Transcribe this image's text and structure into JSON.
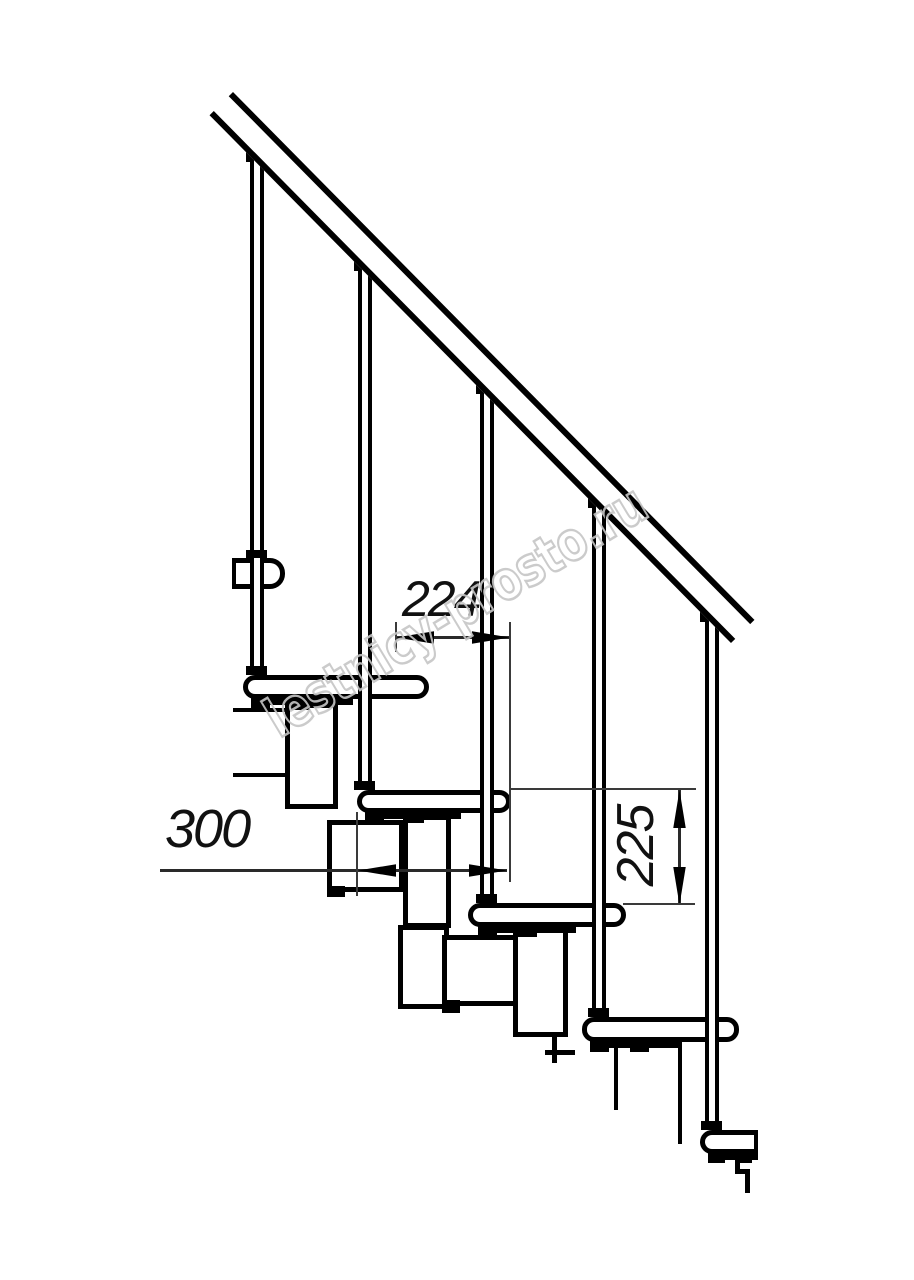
{
  "drawing": {
    "title": "Modular staircase side-view technical drawing",
    "watermark_text": "lestnicy-prosto.ru",
    "colors": {
      "line": "#000000",
      "background": "#ffffff",
      "watermark": "#c6c6c6"
    },
    "counts": {
      "balusters": 5,
      "treads": 6,
      "stringer_modules": 7,
      "handrail": 1
    }
  },
  "dimensions": {
    "run": {
      "label": "224",
      "orientation": "horizontal"
    },
    "depth": {
      "label": "300",
      "orientation": "horizontal"
    },
    "rise": {
      "label": "225",
      "orientation": "vertical"
    }
  }
}
